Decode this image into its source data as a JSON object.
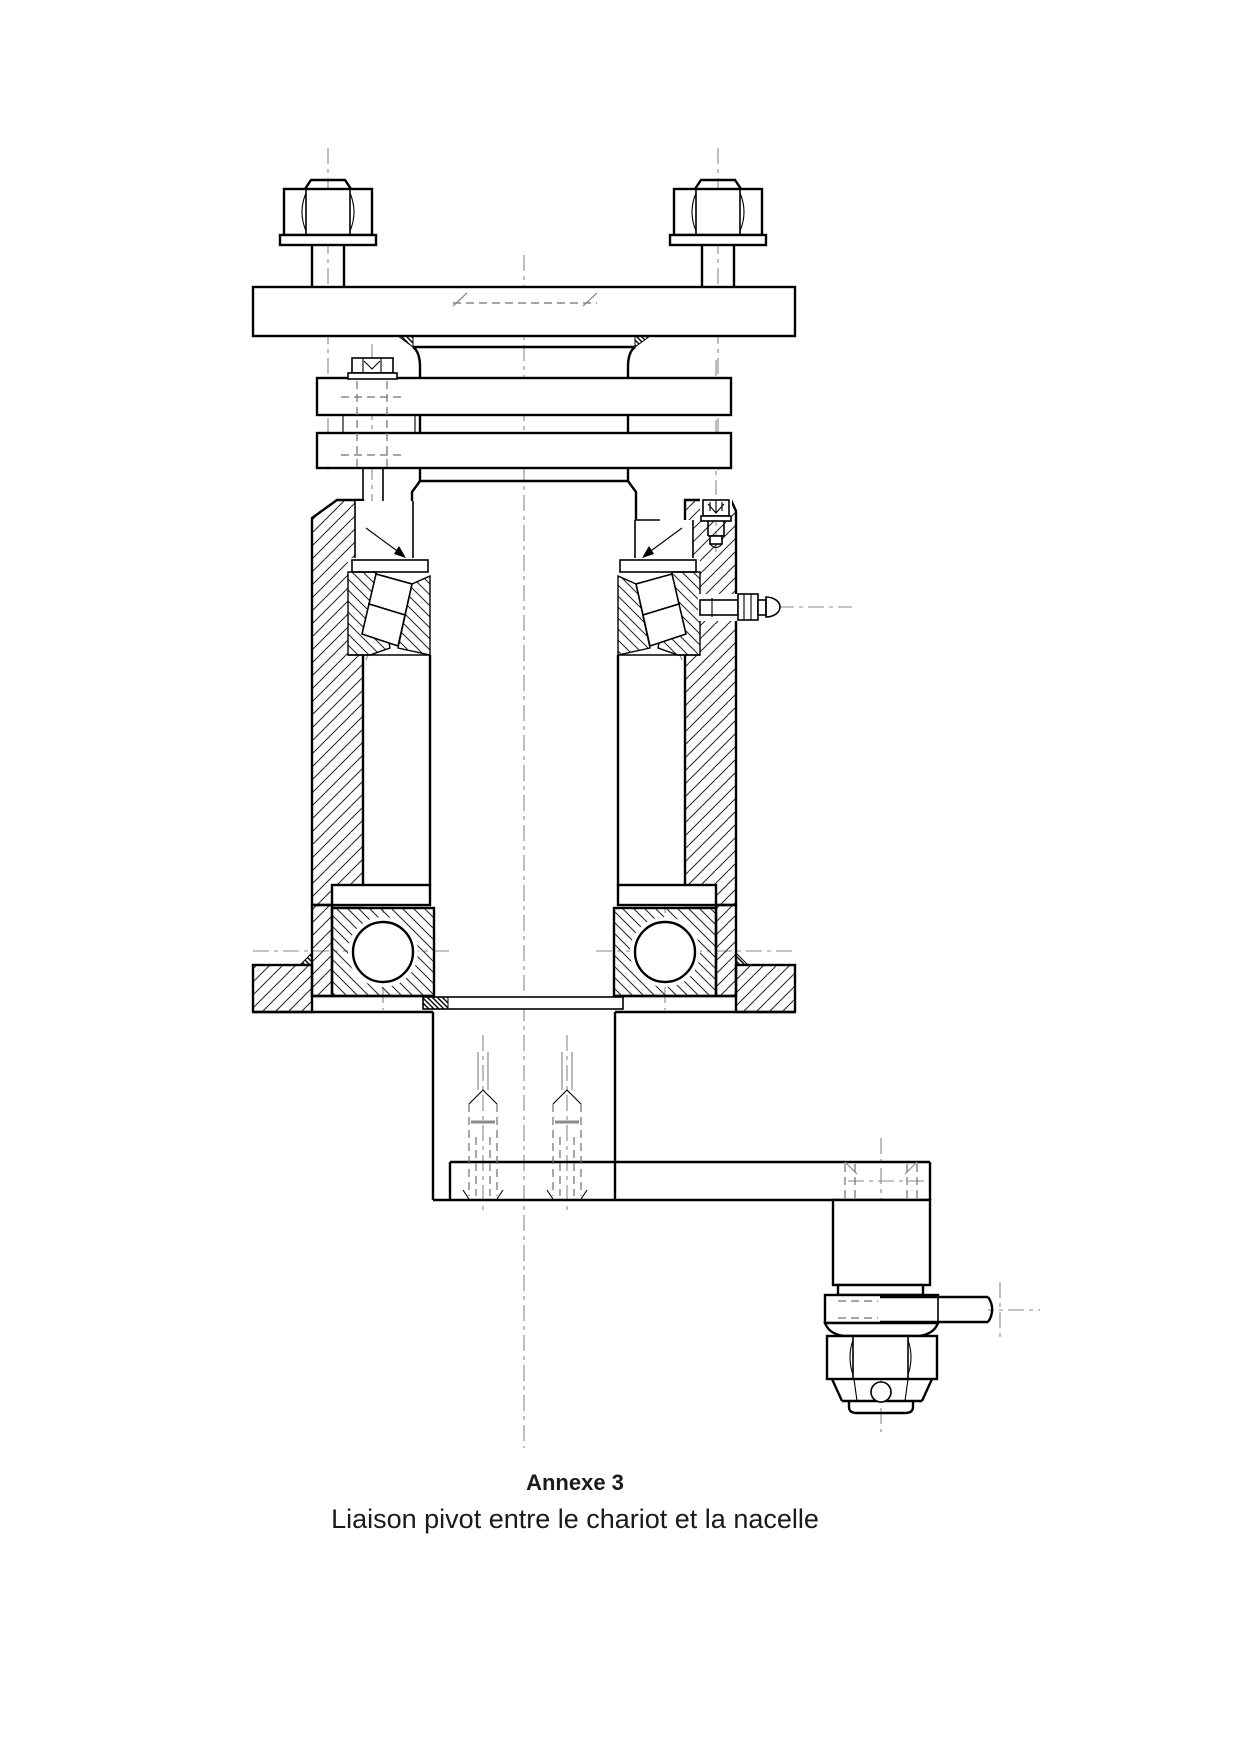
{
  "caption": {
    "title": "Annexe 3",
    "subtitle": "Liaison pivot entre le chariot et la nacelle"
  },
  "colors": {
    "background": "#ffffff",
    "line": "#000000",
    "centerline": "#8a8a8a",
    "hidden_line": "#6f6f6f",
    "text": "#1a1a1a"
  }
}
